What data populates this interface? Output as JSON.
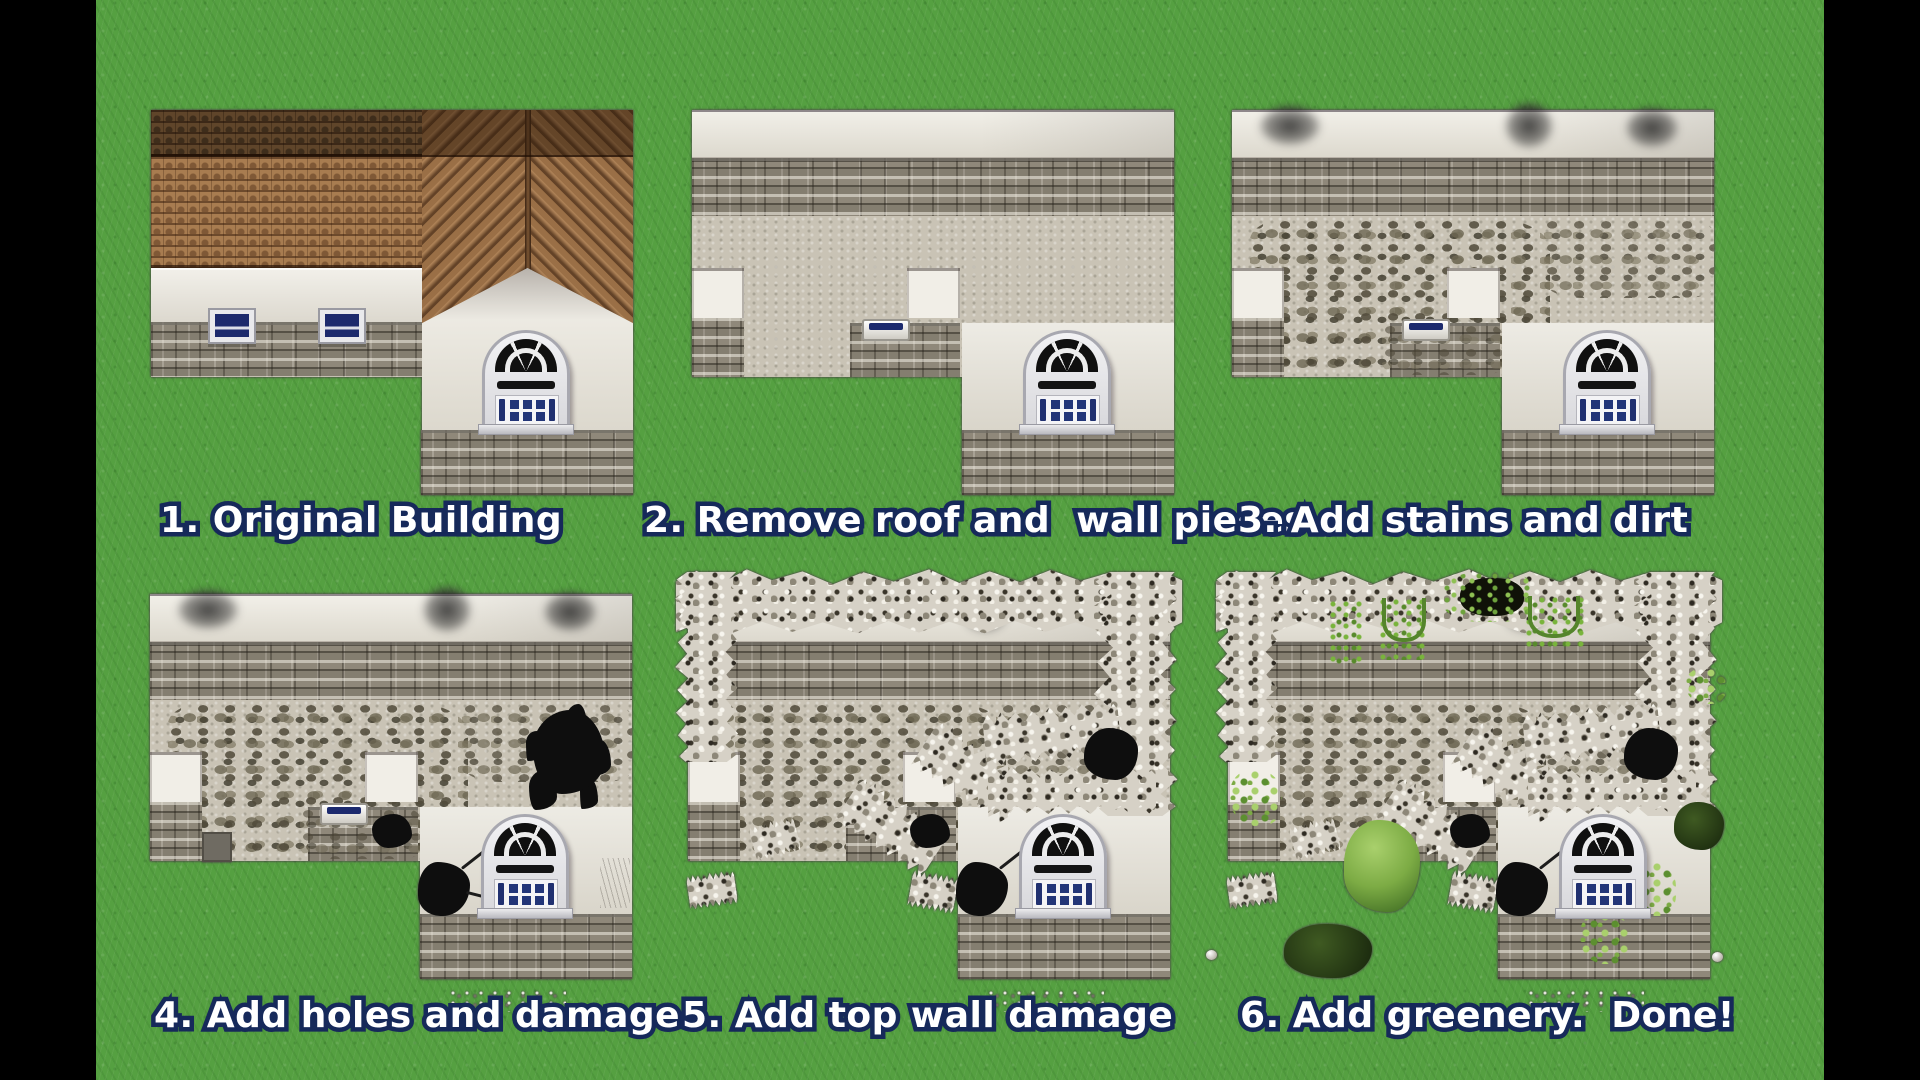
{
  "scene": {
    "description": "Six-step RPG map tutorial showing how to turn a building into a ruin",
    "letterbox_color": "#000000",
    "grass_color": "#55a041",
    "caption_fill": "#ffffff",
    "caption_outline": "#16295a"
  },
  "panels": [
    {
      "step": 1,
      "label": "1. Original Building"
    },
    {
      "step": 2,
      "label": "2. Remove roof and  wall pieces"
    },
    {
      "step": 3,
      "label": "3. Add stains and dirt"
    },
    {
      "step": 4,
      "label": "4. Add holes and damage"
    },
    {
      "step": 5,
      "label": "5. Add top wall damage"
    },
    {
      "step": 6,
      "label": "6. Add greenery.  Done!"
    }
  ],
  "palette": {
    "roof_brown": "#a87c50",
    "roof_dark_brown": "#5f452a",
    "stone_grey": "#8f887a",
    "plaster": "#c9c3b5",
    "window_blue": "#223578",
    "vine_green": "#6da23c"
  }
}
